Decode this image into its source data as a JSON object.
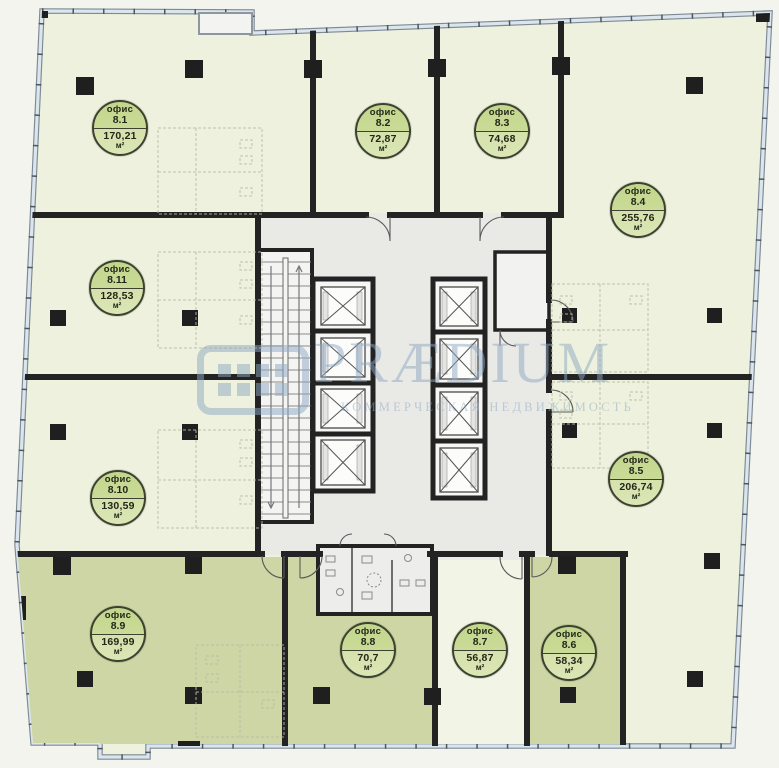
{
  "watermark": {
    "brand": "PRÆDIUM",
    "tagline": "КОММЕРЧЕСКАЯ НЕДВИЖИМОСТЬ"
  },
  "labels": {
    "office_word": "офис",
    "area_unit": "м²"
  },
  "offices": [
    {
      "id": "8.1",
      "area": "170,21"
    },
    {
      "id": "8.2",
      "area": "72,87"
    },
    {
      "id": "8.3",
      "area": "74,68"
    },
    {
      "id": "8.4",
      "area": "255,76"
    },
    {
      "id": "8.5",
      "area": "206,74"
    },
    {
      "id": "8.6",
      "area": "58,34"
    },
    {
      "id": "8.7",
      "area": "56,87"
    },
    {
      "id": "8.8",
      "area": "70,7"
    },
    {
      "id": "8.9",
      "area": "169,99"
    },
    {
      "id": "8.10",
      "area": "130,59"
    },
    {
      "id": "8.11",
      "area": "128,53"
    }
  ],
  "colors": {
    "room_light": "#eef1dd",
    "room_dark": "#cdd6a4",
    "core_gray": "#e9e9e6",
    "wall": "#232323",
    "badge_fill": "#c9db97",
    "badge_border": "#3c4130",
    "facade": "#d7e2ea",
    "watermark": "#8ea8c3"
  }
}
